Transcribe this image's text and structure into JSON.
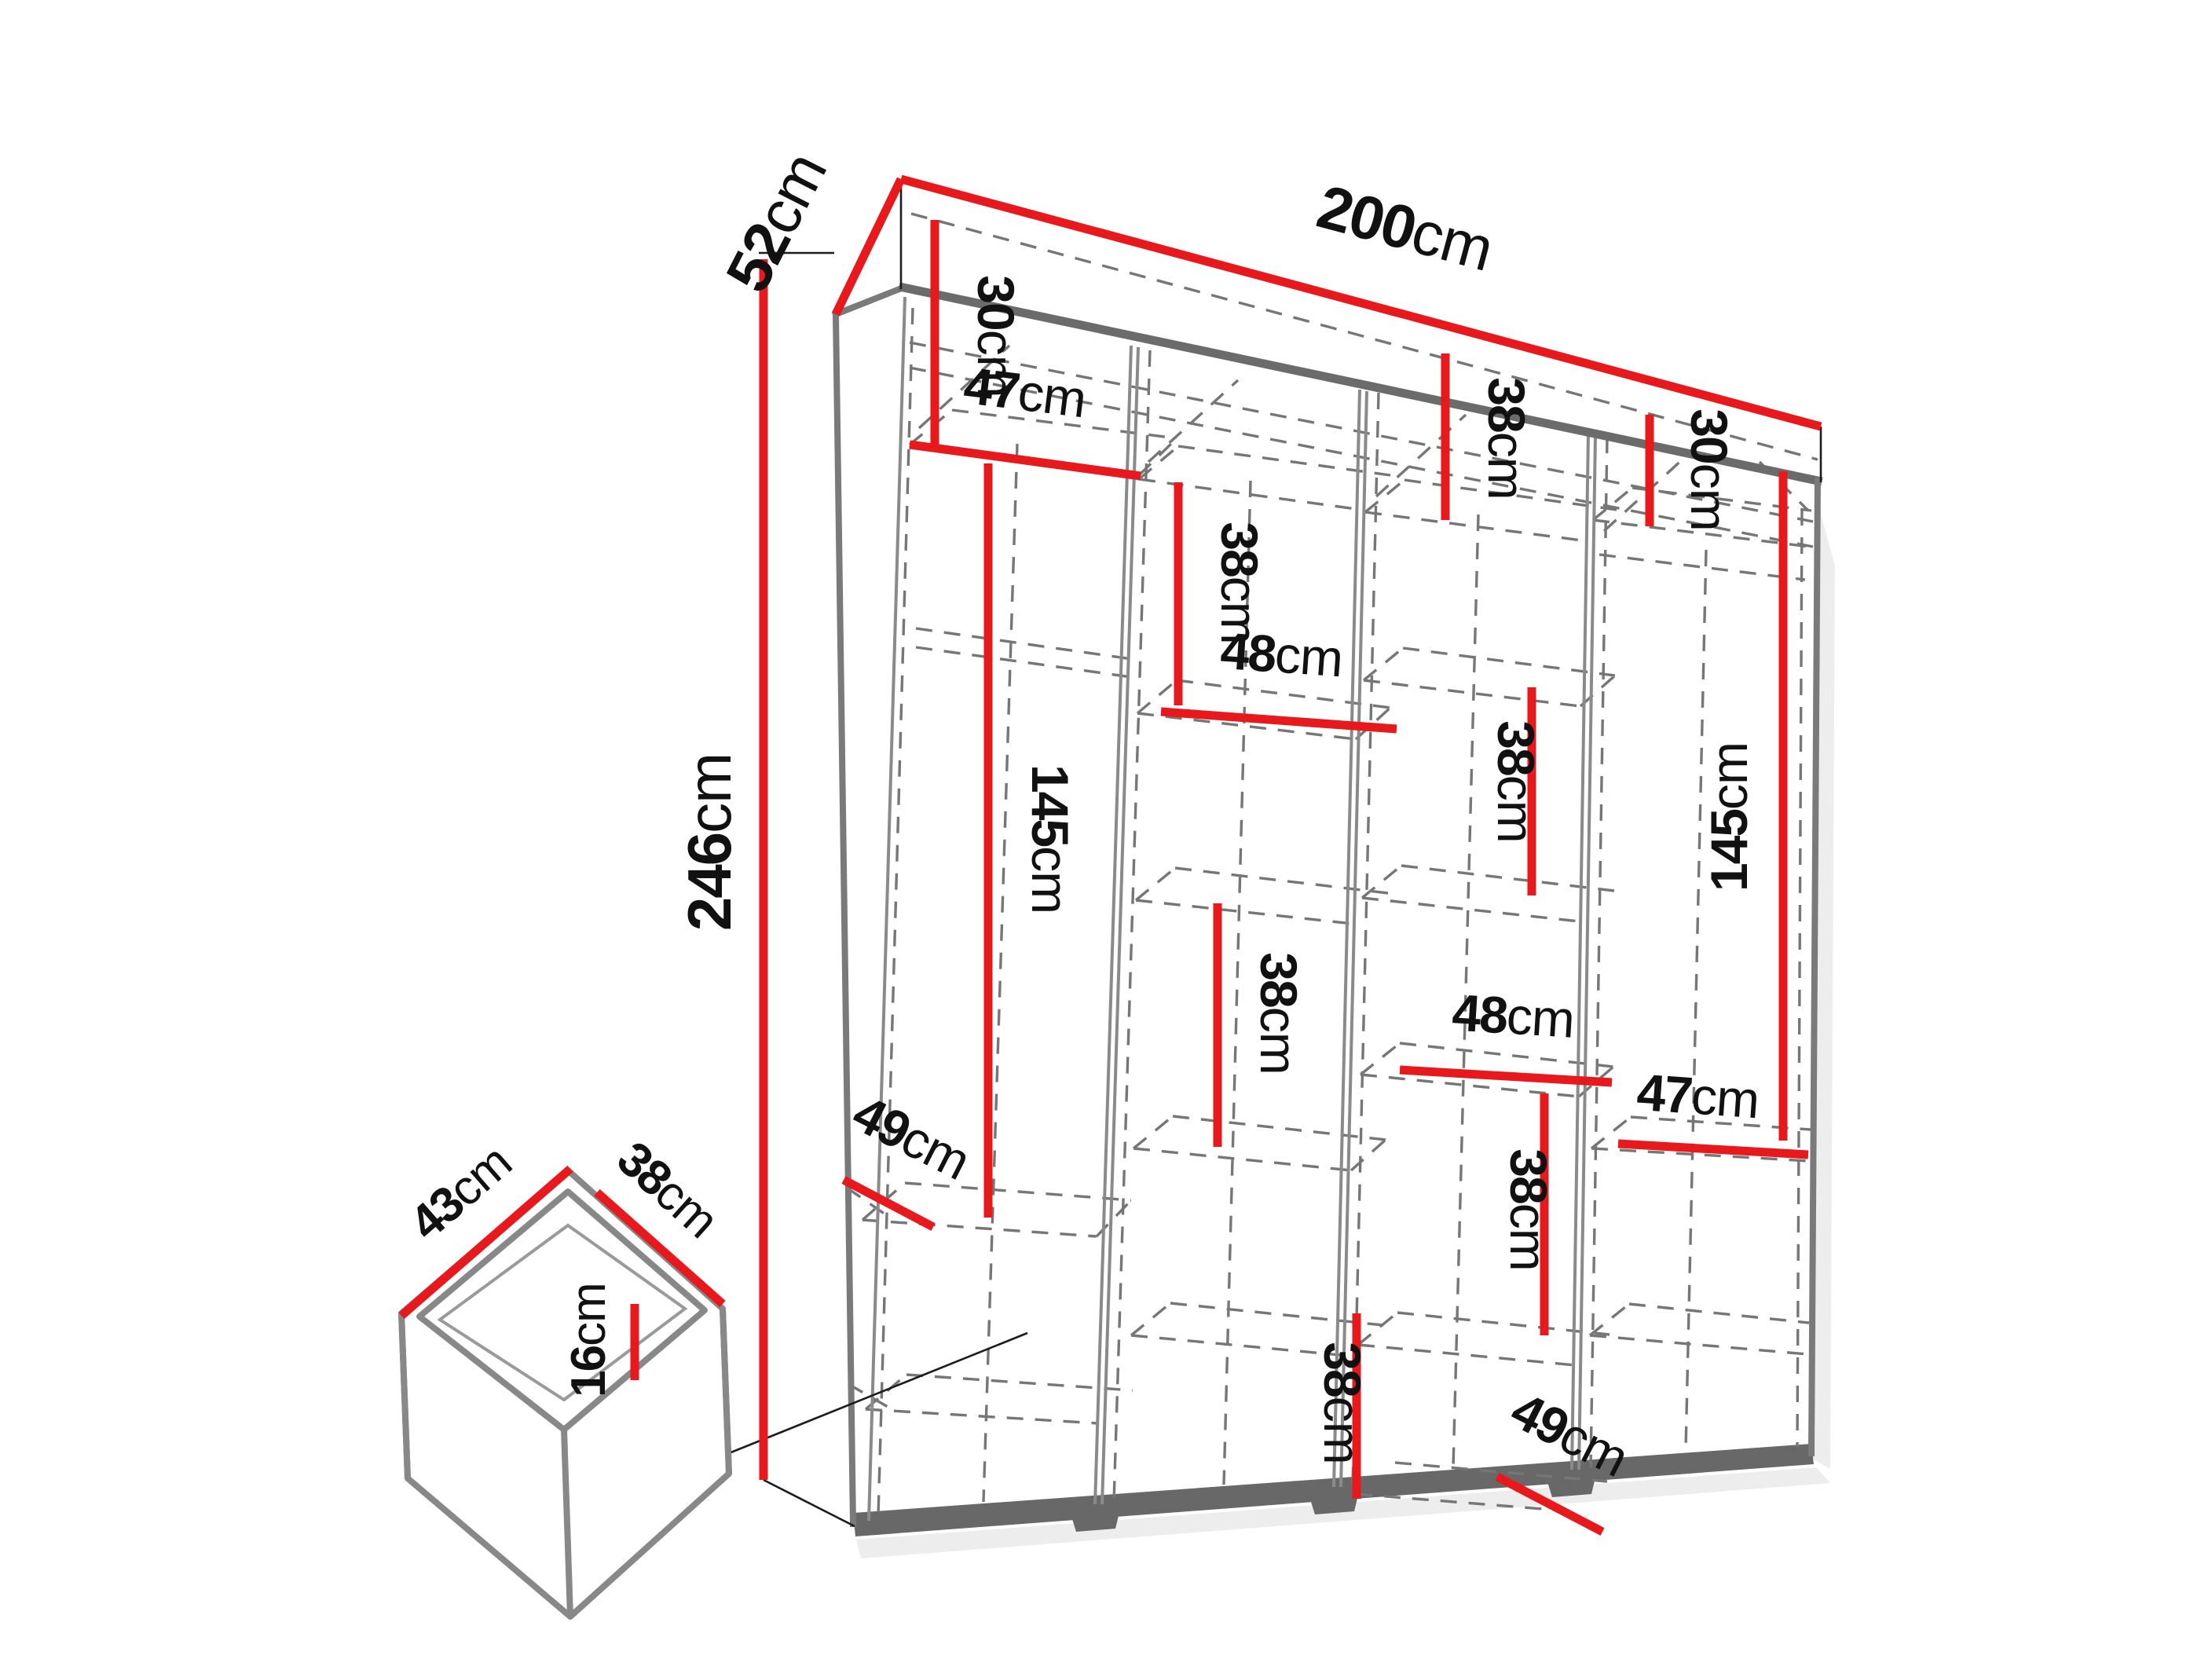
{
  "diagram": {
    "type": "furniture-dimension-drawing",
    "subject": "four-section wardrobe with interior shelving and drawer detail",
    "colors": {
      "dimension_line": "#e8191c",
      "structure": "#7a7a7a",
      "base": "#686868",
      "text": "#111111",
      "background": "#ffffff"
    },
    "overall": {
      "width": {
        "value": "200",
        "unit": "cm"
      },
      "depth": {
        "value": "52",
        "unit": "cm"
      },
      "height": {
        "value": "246",
        "unit": "cm"
      }
    },
    "drawer": {
      "width": {
        "value": "43",
        "unit": "cm"
      },
      "depth": {
        "value": "38",
        "unit": "cm"
      },
      "height": {
        "value": "16",
        "unit": "cm"
      }
    },
    "labels": {
      "w200": {
        "value": "200",
        "unit": "cm"
      },
      "d52": {
        "value": "52",
        "unit": "cm"
      },
      "h246": {
        "value": "246",
        "unit": "cm"
      },
      "c1_30": {
        "value": "30",
        "unit": "cm"
      },
      "c1_47": {
        "value": "47",
        "unit": "cm"
      },
      "c1_145": {
        "value": "145",
        "unit": "cm"
      },
      "c1_49": {
        "value": "49",
        "unit": "cm"
      },
      "c2_38a": {
        "value": "38",
        "unit": "cm"
      },
      "c2_48": {
        "value": "48",
        "unit": "cm"
      },
      "c2_38b": {
        "value": "38",
        "unit": "cm"
      },
      "c3_38a": {
        "value": "38",
        "unit": "cm"
      },
      "c3_38b": {
        "value": "38",
        "unit": "cm"
      },
      "c3_48": {
        "value": "48",
        "unit": "cm"
      },
      "c3_38c": {
        "value": "38",
        "unit": "cm"
      },
      "c3_38d": {
        "value": "38",
        "unit": "cm"
      },
      "c3_49": {
        "value": "49",
        "unit": "cm"
      },
      "c4_30": {
        "value": "30",
        "unit": "cm"
      },
      "c4_145": {
        "value": "145",
        "unit": "cm"
      },
      "c4_47": {
        "value": "47",
        "unit": "cm"
      },
      "dr_43": {
        "value": "43",
        "unit": "cm"
      },
      "dr_38": {
        "value": "38",
        "unit": "cm"
      },
      "dr_16": {
        "value": "16",
        "unit": "cm"
      }
    },
    "interior_dimensions_cm": {
      "column1": [
        "30",
        "47",
        "145",
        "49"
      ],
      "column2": [
        "38",
        "48",
        "38"
      ],
      "column3": [
        "38",
        "38",
        "48",
        "38",
        "38",
        "49"
      ],
      "column4": [
        "30",
        "145",
        "47"
      ]
    }
  }
}
